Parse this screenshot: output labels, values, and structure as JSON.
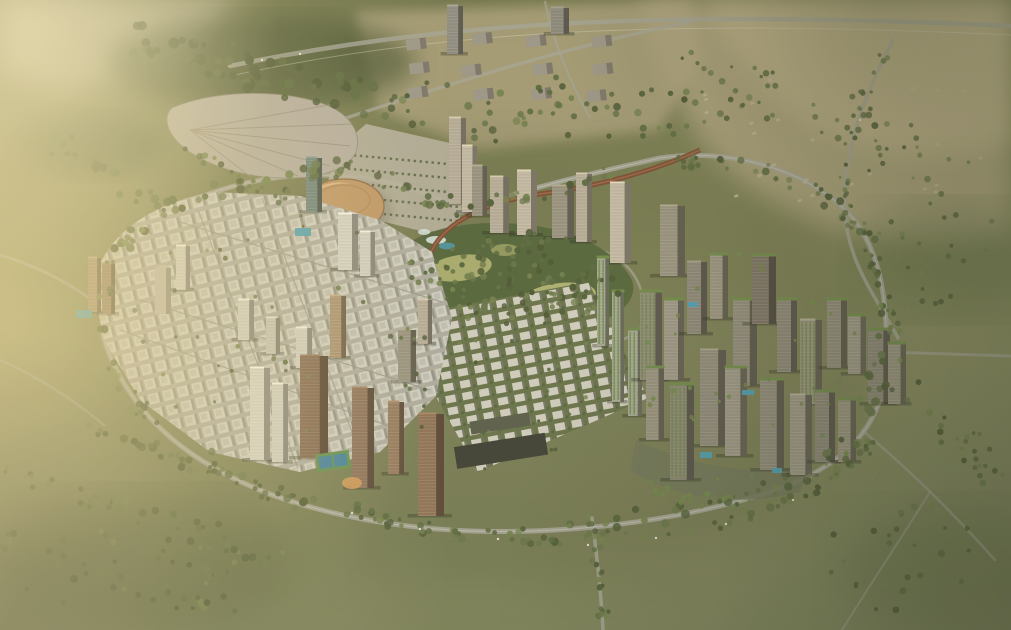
{
  "scene": {
    "kind": "aerial-masterplan-render",
    "landmarks": [
      "exhibition-center",
      "dome-arena",
      "central-park",
      "villa-grid",
      "high-rise-arc",
      "terraced-tower-cluster",
      "ring-boulevard",
      "desert-outskirts"
    ]
  },
  "palette": {
    "land_top": "#6f744b",
    "land_mid": "#82865c",
    "land_low": "#7d845c",
    "desert": "#b3a783",
    "desert_light": "#c9ba93",
    "farm_light": "#cac3ae",
    "forest_dark": "#4a5734",
    "tree_green": "#5a6a40",
    "tree_light": "#72814e",
    "lawn": "#a8ad6e",
    "park_green": "#54653c",
    "villa_ground": "#66724a",
    "road": "#a5a599",
    "road_light": "#c2c1b4",
    "block_light": "#d2d1c6",
    "block_mid": "#b2b1a5",
    "block_shadow": "#8c8c80",
    "tower_face": "#b7ae9a",
    "tower_cream": "#c3baa5",
    "tower_grey": "#97927f",
    "tower_dark": "#7b7265",
    "bronze_face": "#8a6f58",
    "bronze_deep": "#7f644e",
    "bronze_light": "#95795d",
    "green_roof": "#6f8a4a",
    "pool_blue": "#4b9fb5",
    "fan_roof": "#b5afa2",
    "fan_ridge": "#948e7c",
    "dome": "#bf9766",
    "rail_rust": "#7c4b32",
    "parking": "#b7b1a0",
    "water_white": "#d7e6e3",
    "court_green": "#5f8f4f",
    "court_blue": "#3f7f9f",
    "play_orange": "#d09a5a",
    "dark_slab": "#3e4136",
    "teal_glass": "#6a827b",
    "cylinder": "#bdbaab"
  }
}
